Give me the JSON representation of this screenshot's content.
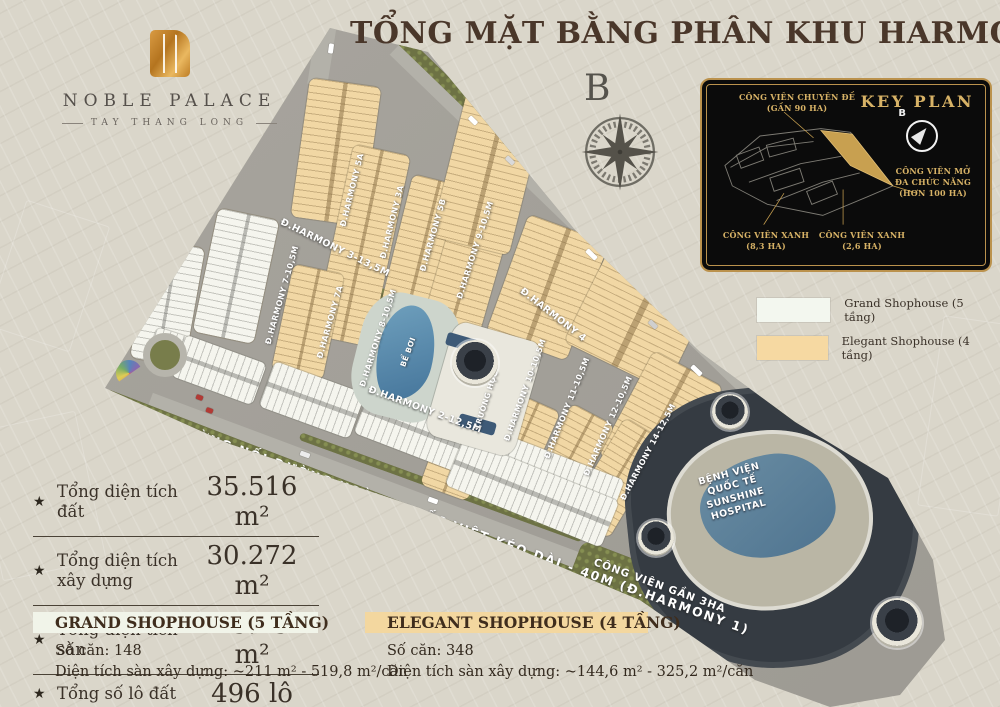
{
  "title": "TỔNG MẶT BẰNG PHÂN KHU HARMONY",
  "logo": {
    "name": "NOBLE PALACE",
    "subtitle": "TAY THANG LONG"
  },
  "compass": {
    "north": "B"
  },
  "icons": {
    "star": "★"
  },
  "key_plan": {
    "title": "KEY PLAN",
    "north": "B",
    "labels": {
      "theme_park": [
        "CÔNG VIÊN CHUYÊN ĐỀ",
        "(GẦN 90 HA)"
      ],
      "multi_park": [
        "CÔNG VIÊN MỞ",
        "ĐA CHỨC NĂNG",
        "(HƠN 100 HA)"
      ],
      "green_park_1": [
        "CÔNG VIÊN XANH",
        "(8,3 HA)"
      ],
      "green_park_2": [
        "CÔNG VIÊN XANH",
        "(2,6 HA)"
      ]
    }
  },
  "legend": {
    "items": [
      {
        "label": "Grand Shophouse (5 tầng)",
        "color": "#f3f7ef"
      },
      {
        "label": "Elegant Shophouse (4 tầng)",
        "color": "#f6d9a2"
      }
    ]
  },
  "stats": {
    "items": [
      {
        "label": "Tổng diện tích đất",
        "value": "35.516 m²"
      },
      {
        "label": "Tổng diện tích xây dựng",
        "value": "30.272 m²"
      },
      {
        "label": "Tổng diện tích sàn",
        "value": "125.154 m²"
      },
      {
        "label": "Tổng số lô đất",
        "value": "496 lô"
      }
    ]
  },
  "info_blocks": {
    "grand": {
      "title": "GRAND SHOPHOUSE (5 TẦNG)",
      "units": "Số căn: 148",
      "area": "Diện tích sàn xây dựng: ~211 m² - 519,8 m²/căn"
    },
    "elegant": {
      "title": "ELEGANT SHOPHOUSE (4 TẦNG)",
      "units": "Số căn: 348",
      "area": "Diện tích sàn xây dựng: ~144,6 m² - 325,2 m²/căn"
    }
  },
  "map": {
    "streets": [
      "Đ.HARMONY 6-50M",
      "Đ.HARMONY 5 (20,5M)",
      "Đ.HARMONY 3-13,5M",
      "Đ.HARMONY 5A",
      "Đ.HARMONY 3A",
      "Đ.HARMONY 5B",
      "Đ.HARMONY 7-10,5M",
      "Đ.HARMONY 7A",
      "Đ.HARMONY 8-10,5M",
      "Đ.HARMONY 9-10,5M",
      "Đ.HARMONY 4",
      "Đ.HARMONY 2-12,5M",
      "Đ.HARMONY 10-10,5M",
      "Đ.HARMONY 11-10,5M",
      "Đ.HARMONY 12-10,5M",
      "Đ.HARMONY 14-12,5M"
    ],
    "places": {
      "main_road": "ĐƯỜNG NỐI ĐƯỜNG HOÀNG QUỐC VIỆT KÉO DÀI - 40M (Đ.HARMONY 1)",
      "park": "CÔNG VIÊN GẦN 3HA",
      "pool": "BỂ BƠI",
      "school": "TRƯỜNG HỌC",
      "hospital": [
        "BỆNH VIỆN",
        "QUỐC TẾ",
        "SUNSHINE",
        "HOSPITAL"
      ]
    }
  },
  "colors": {
    "gold": "#c9a35c",
    "title_brown": "#4a372a",
    "elegant_tan": "#f6d9a2",
    "grand_white": "#f3f7ef",
    "keyplan_bg": "#0b0b0b"
  }
}
